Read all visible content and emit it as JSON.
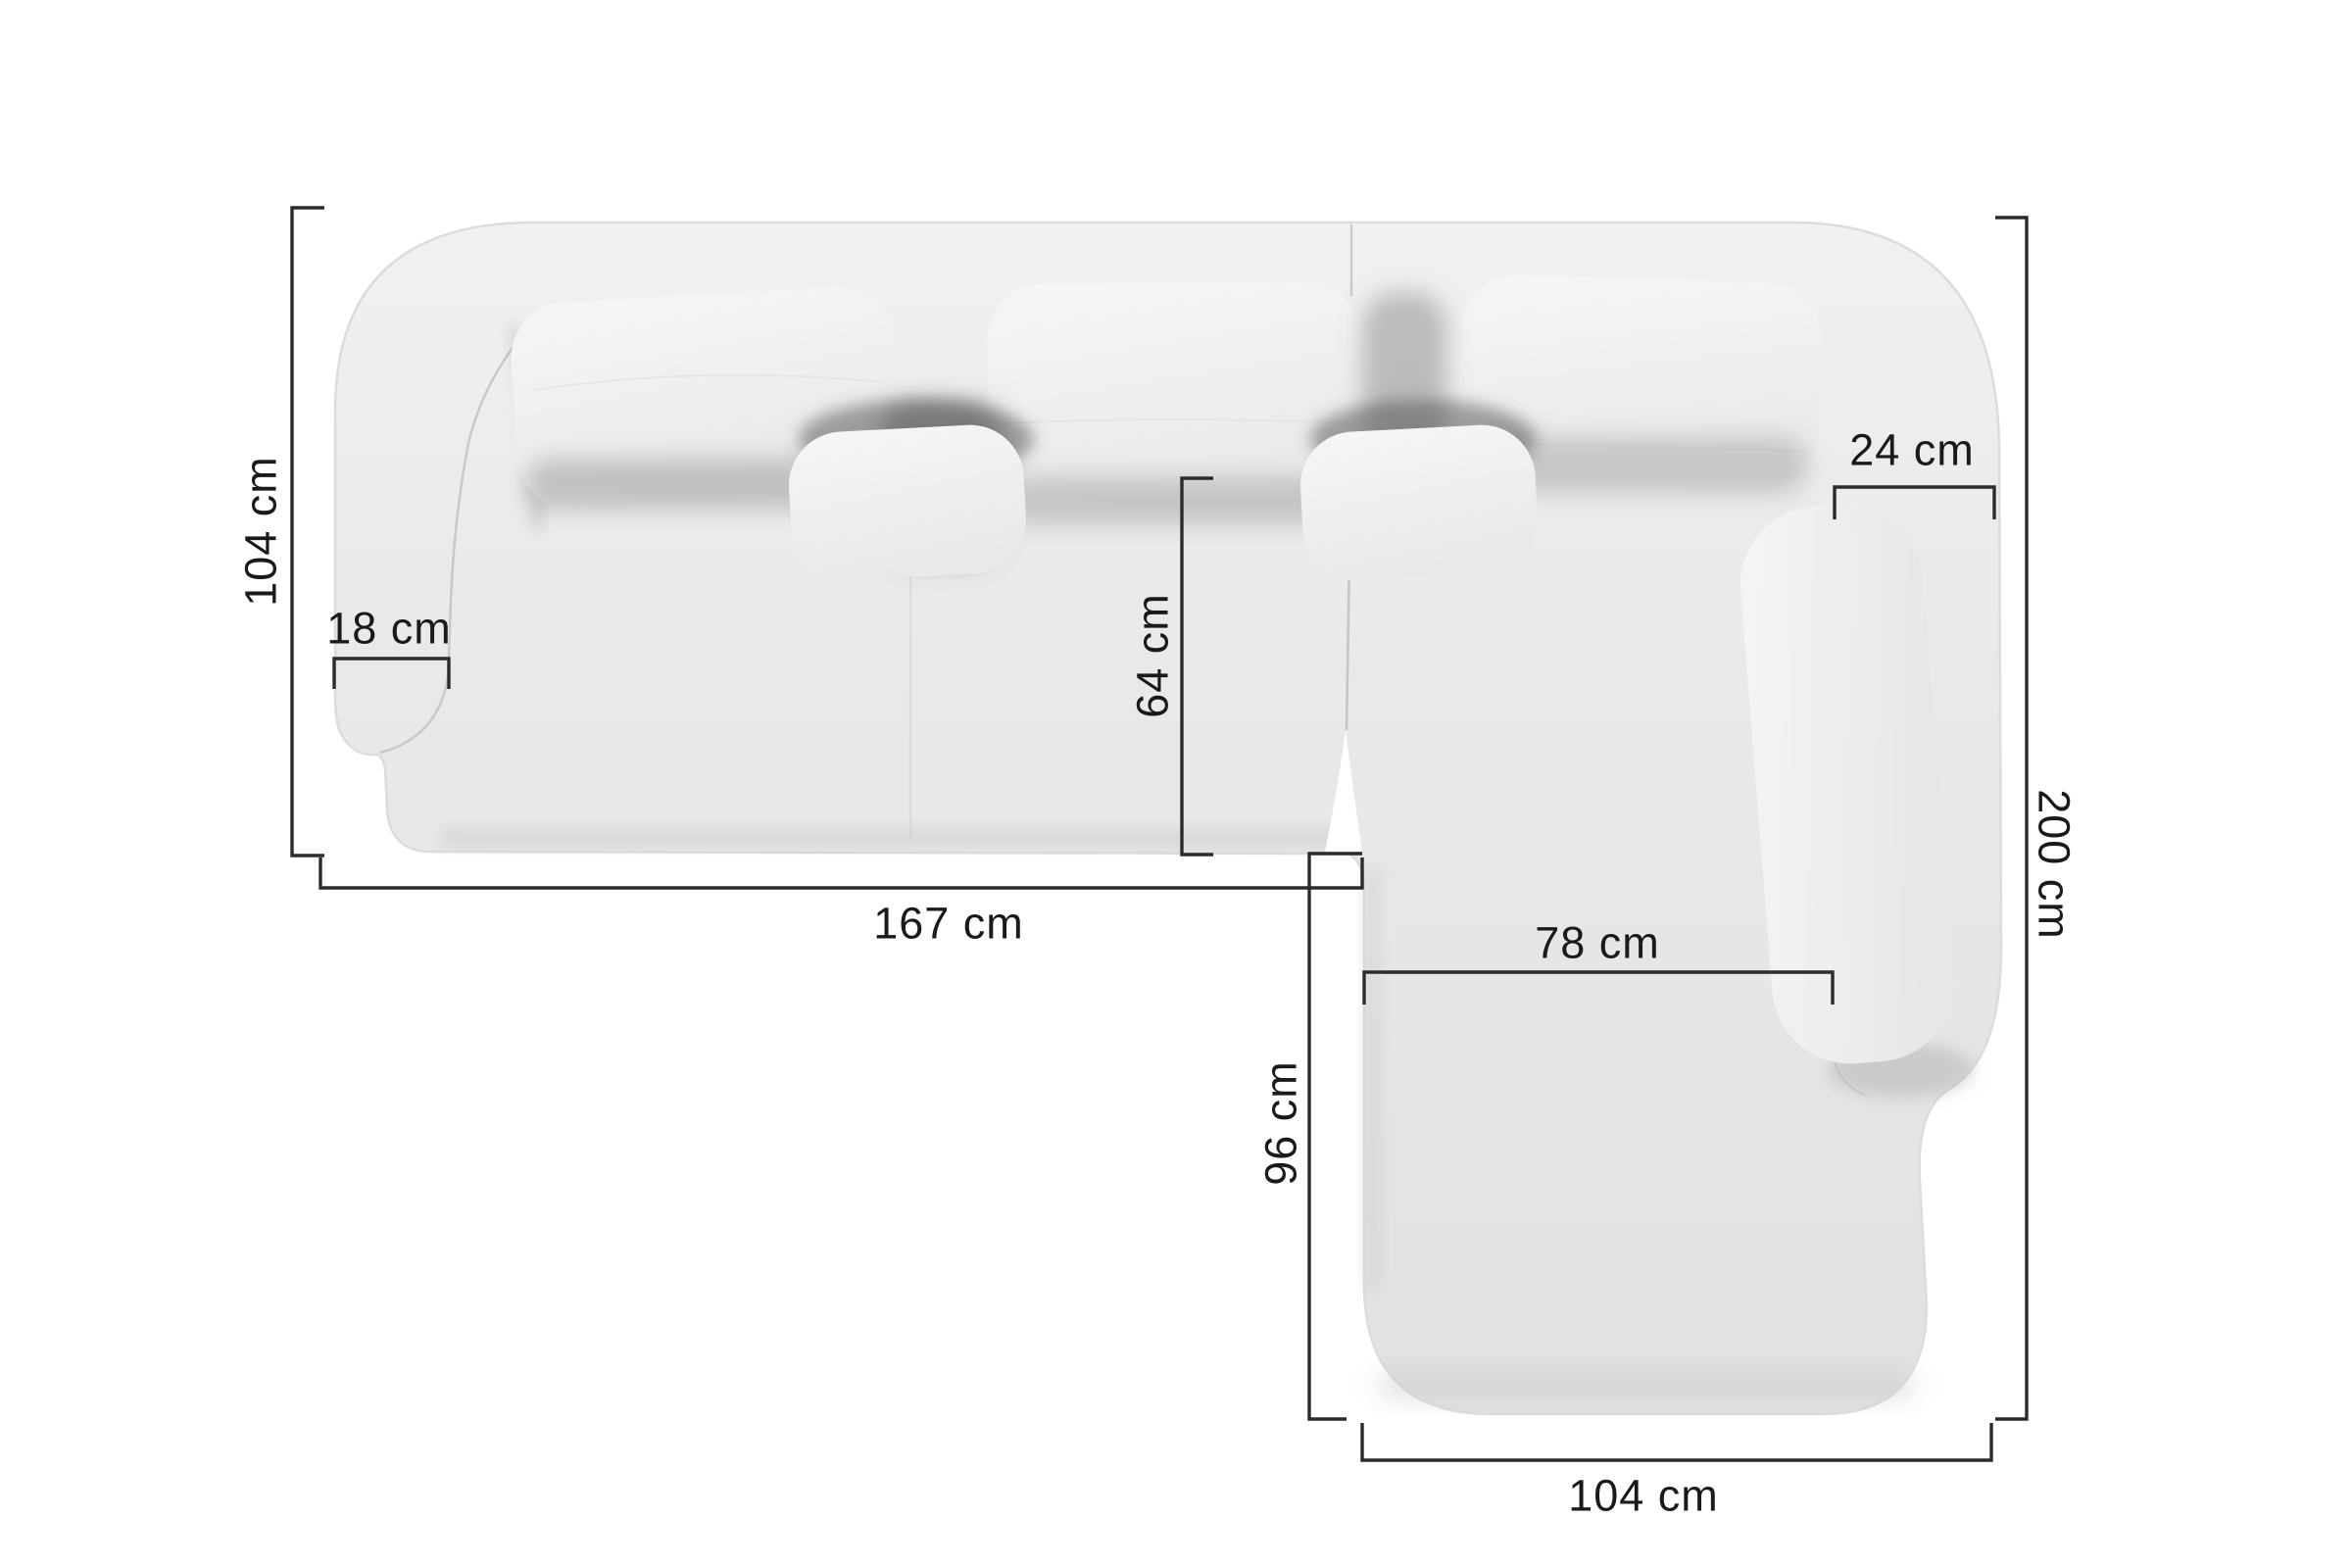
{
  "diagram": {
    "title": "Corner sofa top view with dimensions",
    "unit": "cm",
    "colors": {
      "background": "#ffffff",
      "dimension_line": "#2b2b2b",
      "text": "#1a1a1a",
      "sofa_base": "#e9e9e9",
      "cushion": "#f4f4f4"
    },
    "labels": {
      "left_depth": "104 cm",
      "left_armrest_width": "18 cm",
      "front_length": "167 cm",
      "seat_depth": "64 cm",
      "right_armrest_width": "24 cm",
      "side_length": "200 cm",
      "chaise_seat_width": "78 cm",
      "chaise_seat_depth": "96 cm",
      "chaise_width": "104 cm"
    }
  }
}
